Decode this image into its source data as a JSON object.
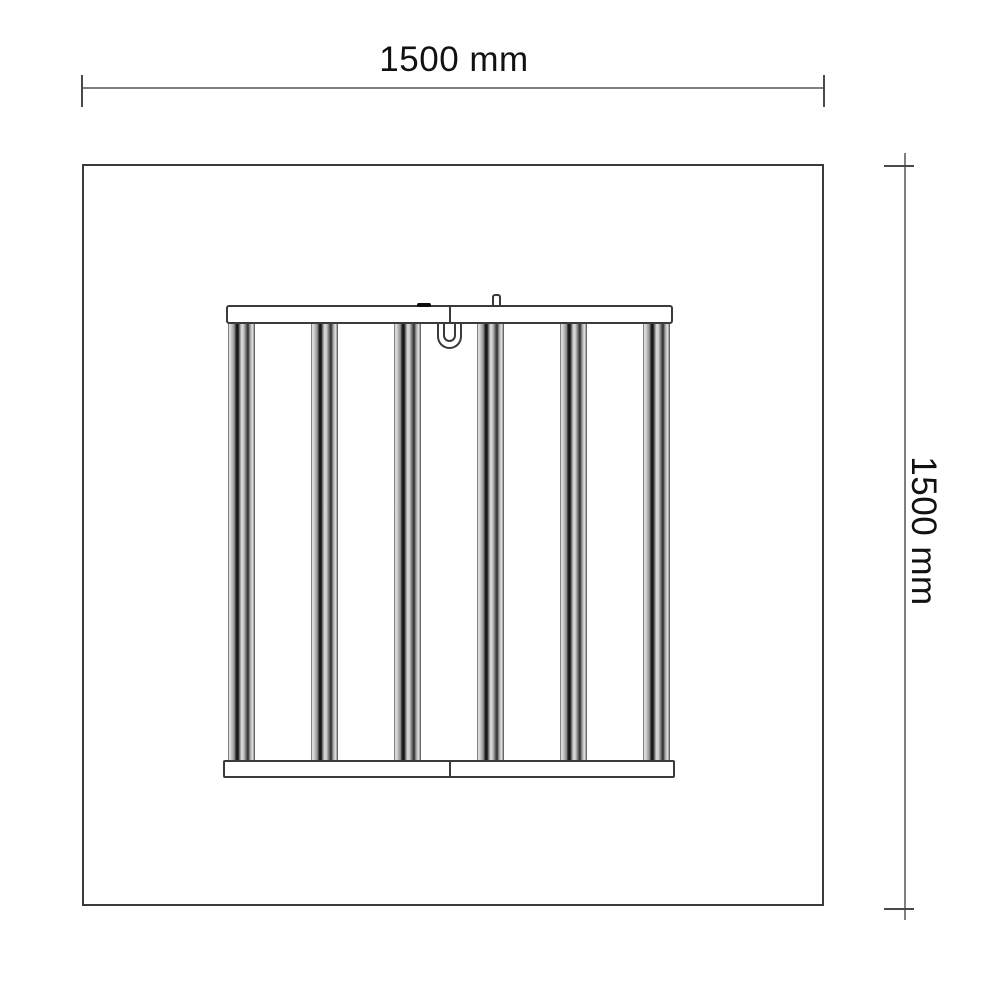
{
  "diagram": {
    "type": "technical-dimension-drawing",
    "width_dimension_label": "1500 mm",
    "height_dimension_label": "1500 mm",
    "fixture": {
      "light_bar_count": 6
    },
    "colors": {
      "background": "#ffffff",
      "outline": "#3a3a3a",
      "dimension_line": "#7f7f7f",
      "dimension_tick": "#4a4a4a",
      "label_text": "#111111"
    }
  }
}
